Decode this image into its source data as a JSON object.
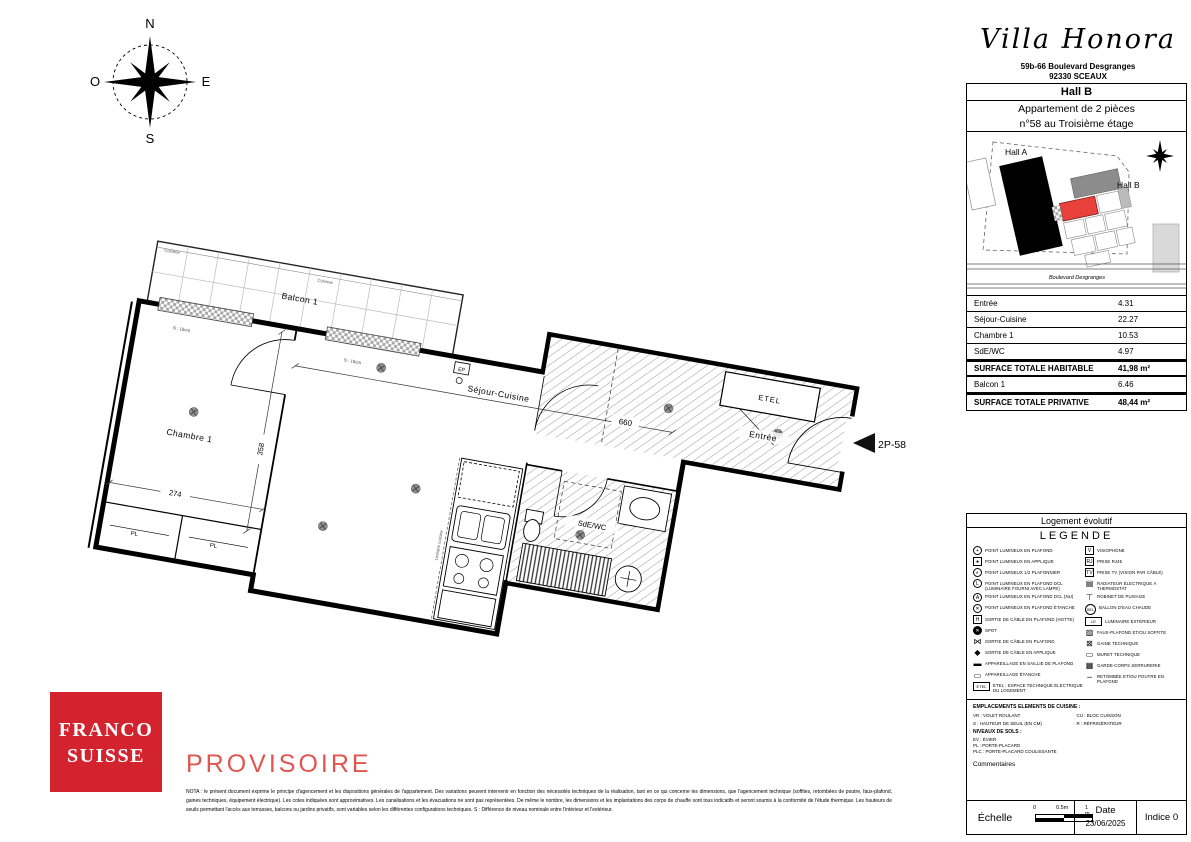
{
  "header": {
    "title": "Villa Honora",
    "address1": "59b-66 Boulevard Desgranges",
    "address2": "92330 SCEAUX",
    "hall": "Hall B",
    "apt1": "Appartement de 2 pièces",
    "apt2": "n°58 au Troisième étage"
  },
  "compass": {
    "n": "N",
    "s": "S",
    "e": "E",
    "o": "O"
  },
  "site_plan": {
    "hall_a": "Hall A",
    "hall_b": "Hall B",
    "street": "Boulevard Desgranges",
    "highlight_color": "#e8413c"
  },
  "floor_plan": {
    "balcony": "Balcon 1",
    "bedroom": "Chambre 1",
    "living": "Séjour-Cuisine",
    "bath": "SdE/WC",
    "entry": "Entrée",
    "etel": "ETEL",
    "closet": "PL",
    "ep": "EP",
    "unit": "2P-58",
    "threshold": "S : 15cm",
    "column": "Colonne",
    "kitchen_line": "Linéaire cuisine",
    "dims": {
      "living_w": "660",
      "bedroom_w": "274",
      "bedroom_d": "358"
    }
  },
  "areas_table": {
    "rows": [
      {
        "label": "Entrée",
        "value": "4.31"
      },
      {
        "label": "Séjour-Cuisine",
        "value": "22.27"
      },
      {
        "label": "Chambre 1",
        "value": "10.53"
      },
      {
        "label": "SdE/WC",
        "value": "4.97"
      }
    ],
    "total_habitable": {
      "label": "SURFACE TOTALE HABITABLE",
      "value": "41,98 m²"
    },
    "balcony": {
      "label": "Balcon 1",
      "value": "6.46"
    },
    "total_private": {
      "label": "SURFACE TOTALE PRIVATIVE",
      "value": "48,44 m²"
    }
  },
  "legend": {
    "box_title": "Logement évolutif",
    "title": "LEGENDE",
    "left_items": [
      {
        "icon": "ceiling-light-icon",
        "shape": "circle",
        "glyph": "+",
        "label": "Point lumineux en plafond"
      },
      {
        "icon": "wall-light-icon",
        "shape": "square",
        "glyph": "●",
        "label": "Point lumineux en applique"
      },
      {
        "icon": "half-ceiling-light-icon",
        "shape": "circle",
        "glyph": "◐",
        "label": "Point lumineux 1/2 plafonnier"
      },
      {
        "icon": "dcl-ceiling-light-icon",
        "shape": "circle",
        "glyph": "L",
        "label": "Point lumineux en plafond DCL (luminaire fourni avec lampe)"
      },
      {
        "icon": "dcl-bare-light-icon",
        "shape": "circle",
        "glyph": "A",
        "label": "Point lumineux en plafond DCL (nu)"
      },
      {
        "icon": "sealed-ceiling-light-icon",
        "shape": "circle",
        "glyph": "✕",
        "label": "Point lumineux en plafond étanche"
      },
      {
        "icon": "hood-cable-outlet-icon",
        "shape": "square",
        "glyph": "H",
        "label": "Sortie de câble en plafond (hotte)"
      },
      {
        "icon": "spot-icon",
        "shape": "circle filled",
        "glyph": "✕",
        "label": "Spot"
      },
      {
        "icon": "ceiling-cable-outlet-icon",
        "shape": "none",
        "glyph": "⋈",
        "label": "Sortie de câble en plafond"
      },
      {
        "icon": "wall-cable-outlet-icon",
        "shape": "none",
        "glyph": "◆",
        "label": "Sortie de câble en applique"
      },
      {
        "icon": "surface-apparatus-icon",
        "shape": "none",
        "glyph": "▬",
        "label": "Appareillage en saillie de plafond"
      },
      {
        "icon": "sealed-apparatus-icon",
        "shape": "none",
        "glyph": "▭",
        "label": "Appareillage étanche"
      },
      {
        "icon": "etel-box-icon",
        "shape": "wide",
        "glyph": "ETEL",
        "label": "ETEL : espace technique électrique du logement"
      }
    ],
    "right_items": [
      {
        "icon": "visiophone-icon",
        "shape": "square",
        "glyph": "V",
        "label": "Visiophone"
      },
      {
        "icon": "rj45-outlet-icon",
        "shape": "square",
        "glyph": "RJ",
        "label": "Prise RJ45"
      },
      {
        "icon": "tv-outlet-icon",
        "shape": "square",
        "glyph": "TV",
        "label": "Prise TV (vision par câble)"
      },
      {
        "icon": "radiator-icon",
        "shape": "none",
        "glyph": "▤",
        "label": "Radiateur électrique à thermostat"
      },
      {
        "icon": "water-tap-icon",
        "shape": "none",
        "glyph": "⊤",
        "label": "Robinet de puisage"
      },
      {
        "icon": "water-heater-icon",
        "shape": "round",
        "glyph": "BEL",
        "label": "Ballon d'eau chaude"
      },
      {
        "icon": "exterior-light-icon",
        "shape": "wide",
        "glyph": "LE",
        "label": "Luminaire extérieur"
      },
      {
        "icon": "soffit-icon",
        "shape": "none",
        "glyph": "▨",
        "label": "Faux-plafond et/ou soffite"
      },
      {
        "icon": "duct-icon",
        "shape": "none",
        "glyph": "⊠",
        "label": "Gaine technique"
      },
      {
        "icon": "low-wall-icon",
        "shape": "none",
        "glyph": "▭",
        "label": "Muret technique"
      },
      {
        "icon": "railing-icon",
        "shape": "none",
        "glyph": "▦",
        "label": "Garde-corps serrurerie"
      },
      {
        "icon": "beam-icon",
        "shape": "none",
        "glyph": "╌",
        "label": "Retombée et/ou poutre en plafond"
      }
    ],
    "kitchen": {
      "title": "EMPLACEMENTS ELEMENTS DE CUISINE :",
      "rows": [
        {
          "a": "VR : Volet roulant",
          "b": "CU : Bloc cuisson"
        },
        {
          "a": "S : Hauteur de seuil (en cm)",
          "b": "R : Réfrigérateur"
        }
      ],
      "levels_title": "NIVEAUX DE SOLS :",
      "abbrevs": [
        "EV : Évier",
        "PL : Porte-placard",
        "PLC : Porte-placard coulissante"
      ],
      "comments": "Commentaires"
    }
  },
  "footer": {
    "scale_label": "Échelle",
    "ticks": [
      "0",
      "0.5m",
      "1 m"
    ],
    "date_label": "Date",
    "date": "23/06/2025",
    "indice": "Indice 0"
  },
  "logo": {
    "top": "FRANCO",
    "bottom": "SUISSE",
    "color": "#d2232e"
  },
  "stamp": "PROVISOIRE",
  "nota": "NOTA : le présent document exprime le principe d'agencement et les dispositions générales de l'appartement. Des variations peuvent intervenir en fonction des nécessités techniques de la réalisation, tant en ce qui concerne les dimensions, que l'agencement technique (soffites, retombées de poutre, faux-plafond, gaines techniques, équipement électrique). Les cotes indiquées sont approximatives. Les canalisations et les évacuations ne sont pas représentées. De même le nombre, les dimensions et les implantations des corps de chauffe sont tous indicatifs et seront soumis à la conformité de l'étude thermique. Les hauteurs de seuils permettant l'accès aux terrasses, balcons ou jardins privatifs, sont variables selon les différentes configurations techniques. S : Différence de niveau nominale entre l'intérieur et l'extérieur."
}
